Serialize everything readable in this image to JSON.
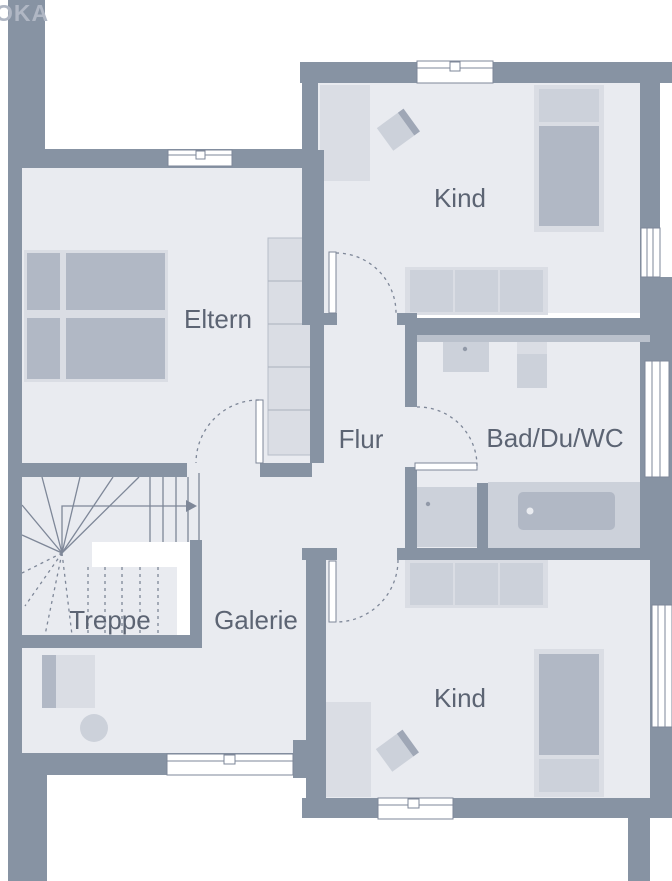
{
  "watermark": "OKA",
  "labels": {
    "kind_top": "Kind",
    "eltern": "Eltern",
    "flur": "Flur",
    "bad": "Bad/Du/WC",
    "treppe": "Treppe",
    "galerie": "Galerie",
    "kind_bottom": "Kind"
  },
  "colors": {
    "wall": "#8793a3",
    "wall_light": "#bac1cc",
    "room": "#e9ebf0",
    "outside": "#ffffff",
    "furn_light": "#dadde4",
    "furn_mid": "#ccd1da",
    "furn_dark": "#b1b8c5",
    "furn_darker": "#9fa7b6",
    "line": "#7e8798",
    "text": "#5c6473",
    "watermark": "#b0b7c4"
  }
}
